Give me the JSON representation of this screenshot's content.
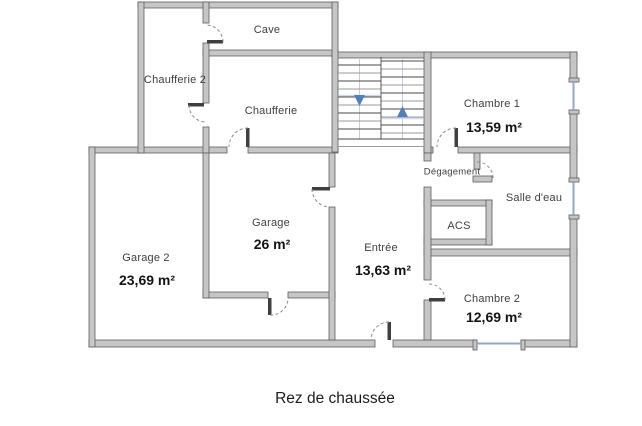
{
  "title": "Rez de chaussée",
  "floor_plan": {
    "rooms": {
      "cave": {
        "label": "Cave"
      },
      "chaufferie2": {
        "label": "Chaufferie 2"
      },
      "chaufferie": {
        "label": "Chaufferie"
      },
      "chambre1": {
        "label": "Chambre 1",
        "area": "13,59 m²"
      },
      "degagement": {
        "label": "Dégagement"
      },
      "salle_deau": {
        "label": "Salle d'eau"
      },
      "acs": {
        "label": "ACS"
      },
      "garage": {
        "label": "Garage",
        "area": "26 m²"
      },
      "garage2": {
        "label": "Garage 2",
        "area": "23,69 m²"
      },
      "entree": {
        "label": "Entrée",
        "area": "13,63 m²"
      },
      "chambre2": {
        "label": "Chambre 2",
        "area": "12,69 m²"
      }
    },
    "stairs": {
      "down_arrow": "down",
      "up_arrow": "up"
    },
    "colors": {
      "wall_fill": "#c6c6c6",
      "wall_edge": "#5e5e5e",
      "door_arc": "#8a8a8a",
      "stair_arrow": "#4f7fbd",
      "window": "#90a7c7",
      "room_label": "#3f3f3f",
      "area_label": "#141414"
    }
  }
}
